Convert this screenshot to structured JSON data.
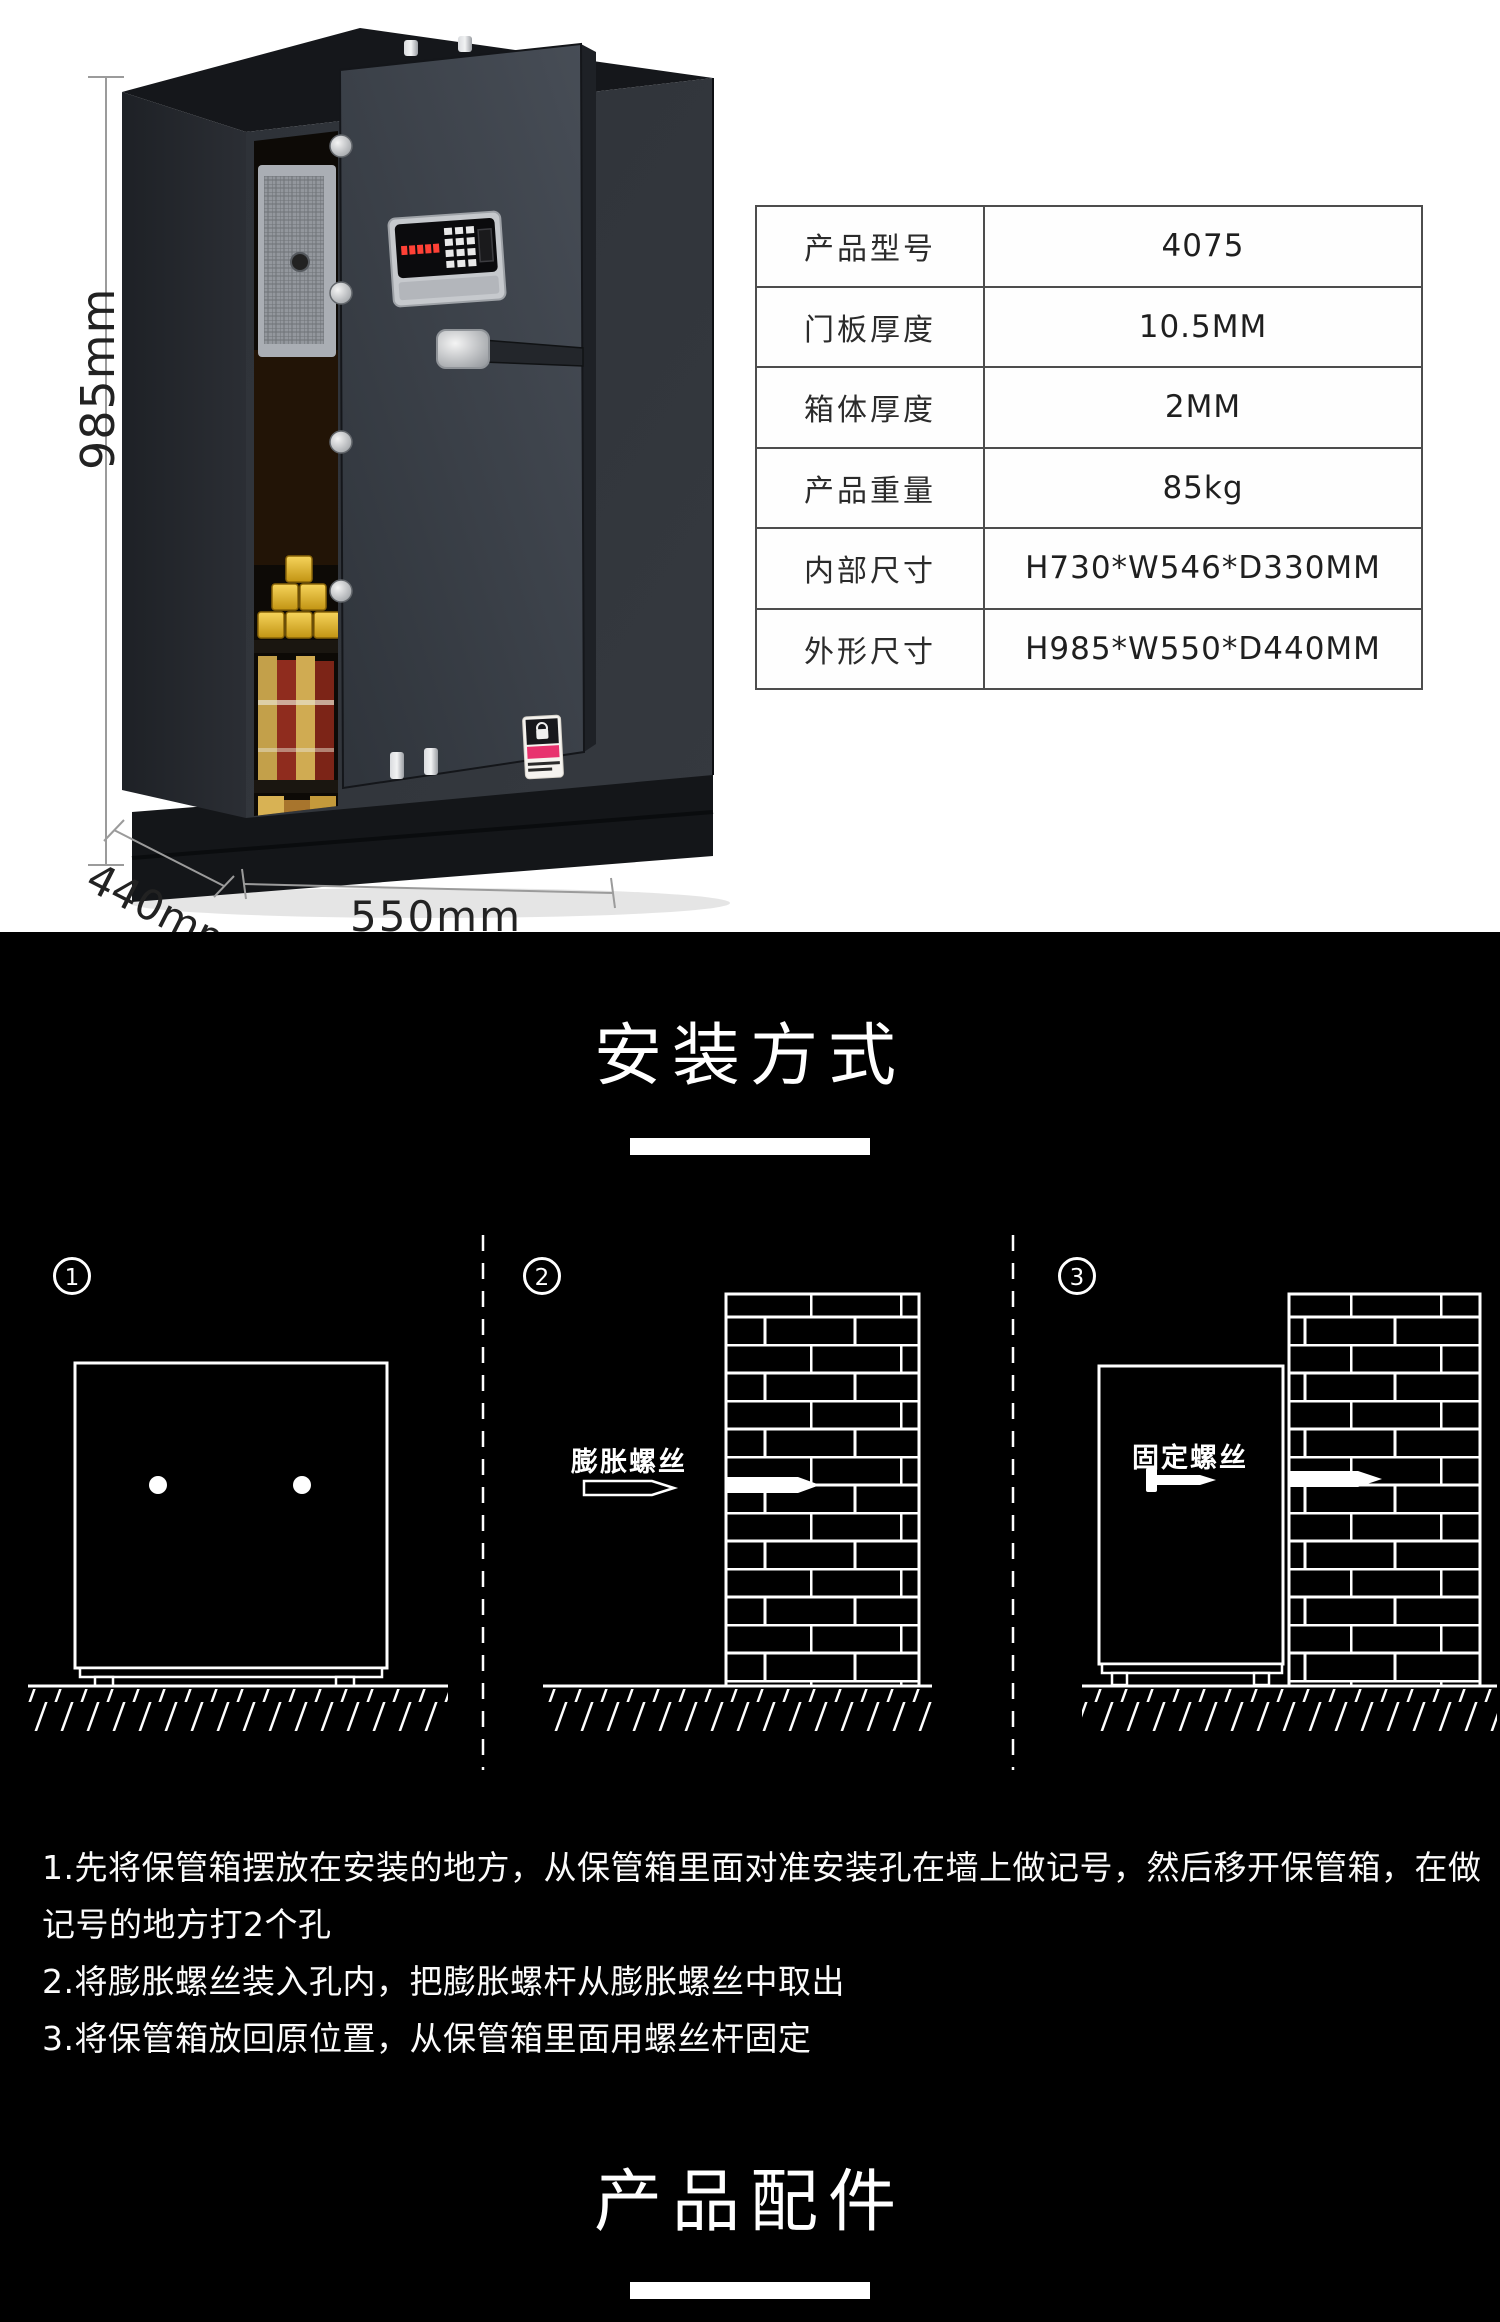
{
  "product": {
    "dimensions": {
      "height": "985mm",
      "depth": "440mm",
      "width": "550mm"
    },
    "spec_table": {
      "rows": [
        {
          "label": "产品型号",
          "value": "4075"
        },
        {
          "label": "门板厚度",
          "value": "10.5MM"
        },
        {
          "label": "箱体厚度",
          "value": "2MM"
        },
        {
          "label": "产品重量",
          "value": "85kg"
        },
        {
          "label": "内部尺寸",
          "value": "H730*W546*D330MM"
        },
        {
          "label": "外形尺寸",
          "value": "H985*W550*D440MM"
        }
      ]
    }
  },
  "installation": {
    "title": "安装方式",
    "step_numbers": [
      "1",
      "2",
      "3"
    ],
    "expansion_screw_label": "膨胀螺丝",
    "fixing_screw_label": "固定螺丝",
    "instruction_lines": [
      "1.先将保管箱摆放在安装的地方，从保管箱里面对准安装孔在墙上做记号，然后移开保管箱，在做",
      "记号的地方打2个孔",
      "2.将膨胀螺丝装入孔内，把膨胀螺杆从膨胀螺丝中取出",
      "3.将保管箱放回原位置，从保管箱里面用螺丝杆固定"
    ]
  },
  "accessories": {
    "title": "产品配件"
  },
  "colors": {
    "section_bg": "#000000",
    "text_on_dark": "#ffffff",
    "table_border": "#4d4d4d",
    "gold": "#e0a92b",
    "sticker_pink": "#e8326e",
    "lcd_red": "#ff4136"
  }
}
